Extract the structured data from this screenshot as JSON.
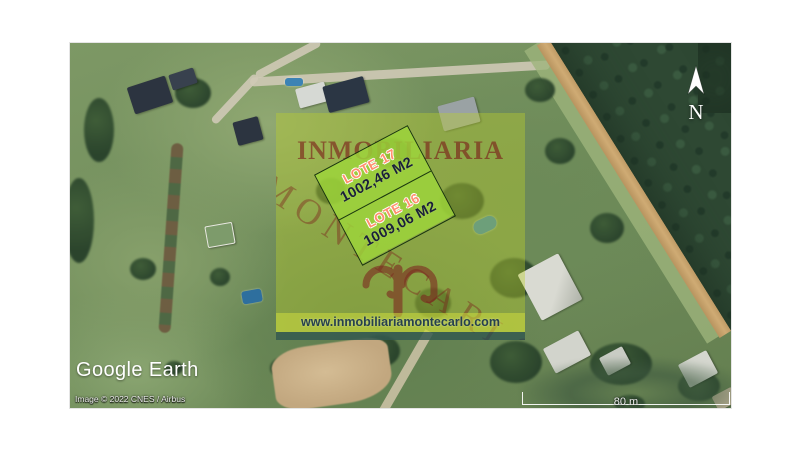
{
  "map": {
    "provider_logo": "Google Earth",
    "attribution": "Image © 2022 CNES / Airbus",
    "scale_bar_label": "80 m",
    "compass_label": "N"
  },
  "listing": {
    "agency_name": "INMOBILIARIA",
    "agency_name_diagonal": "MONTECARLO",
    "website": "www.inmobiliariamontecarlo.com",
    "lots": [
      {
        "name": "LOTE 17",
        "area": "1002,46 M2"
      },
      {
        "name": "LOTE 16",
        "area": "1009,06 M2"
      }
    ]
  },
  "colors": {
    "parcel_fill": "#9DD63A",
    "parcel_border": "#122E0C",
    "lot_name_text": "#FF8F6E",
    "lot_area_text": "#1A2038",
    "watermark_red": "#7A1818",
    "overlay_tint": "#BBD02C",
    "website_text": "#26404E",
    "teal_bar": "#1E4655"
  }
}
